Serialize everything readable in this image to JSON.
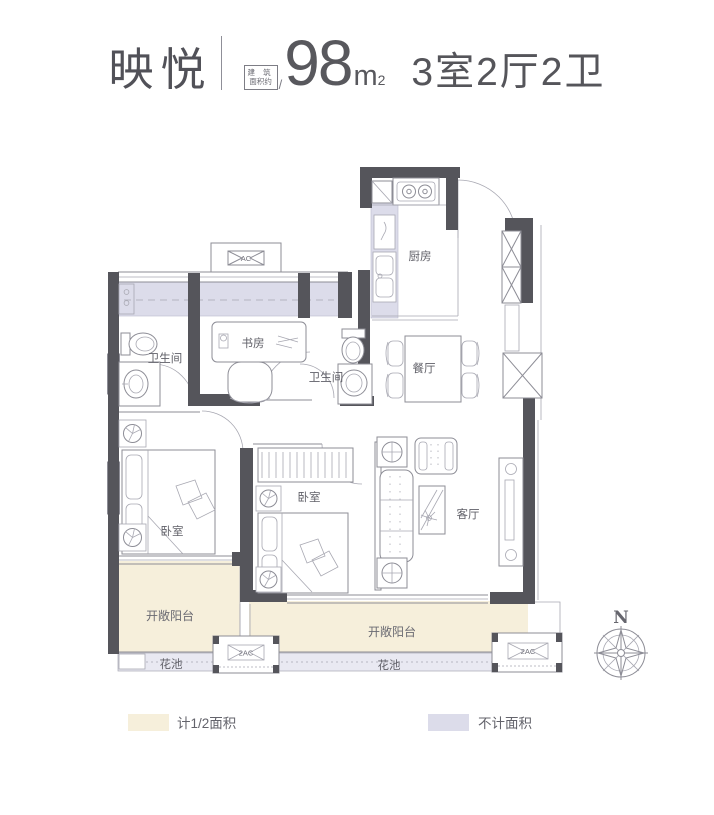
{
  "header": {
    "project_name": "映悦",
    "area_label_line1": "建 筑",
    "area_label_line2": "面积约",
    "slash": "/",
    "area_value": "98",
    "area_unit": "m",
    "area_sup": "2",
    "layout_text": "3室2厅2卫"
  },
  "plan": {
    "rooms": {
      "kitchen": "厨房",
      "bathroom_left": "卫生间",
      "study": "书房",
      "bathroom_middle": "卫生间",
      "dining": "餐厅",
      "bedroom_left": "卧室",
      "bedroom_middle": "卧室",
      "living": "客厅",
      "balcony_left": "开敞阳台",
      "balcony_right": "开敞阳台",
      "flower_bed_left": "花池",
      "flower_bed_right": "花池"
    },
    "labels": {
      "ac": "AC",
      "ac2_left": "2AC",
      "ac2_right": "2AC",
      "compass_north": "N"
    }
  },
  "legend": {
    "items": [
      {
        "label": "计1/2面积",
        "color": "#f6efdb"
      },
      {
        "label": "不计面积",
        "color": "#dcdcea"
      }
    ]
  },
  "colors": {
    "wall": "#55555b",
    "outline": "#8d8d96",
    "half_area_fill": "#f6efdb",
    "excluded_area_fill": "#dcdcea",
    "text": "#58585d"
  }
}
